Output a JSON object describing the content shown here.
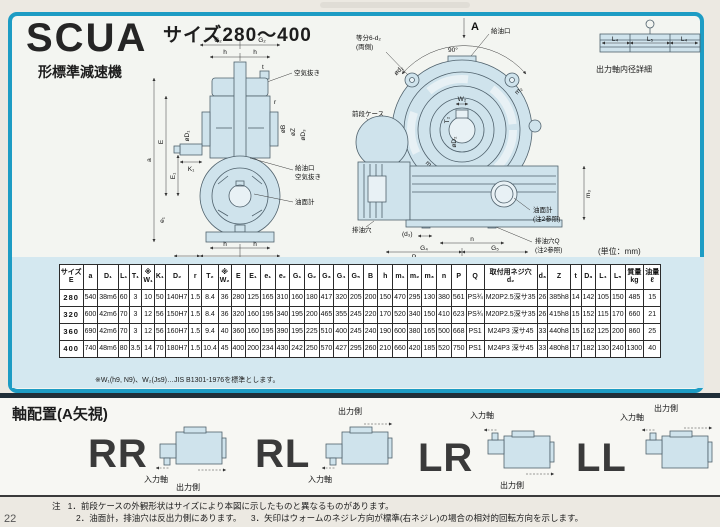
{
  "header": {
    "model": "SCUA",
    "subtitle": "形標準減速機",
    "size_range": "サイズ280～400"
  },
  "unit_note": "(単位：mm)",
  "drawings": {
    "side": {
      "G2": "G₂",
      "h": "h",
      "t": "t",
      "air_vent": "空気抜き",
      "a": "a",
      "E": "E",
      "E1": "E₁",
      "e1": "e₁",
      "dia_D1": "øD₁",
      "K1": "K₁",
      "r": "r",
      "dia_B": "øB",
      "dia_Z": "øZ",
      "dia_D3": "øD₃",
      "oil_port": "給油口",
      "air_vent2": "空気抜き",
      "oil_gauge": "油面計",
      "L1": "L₁",
      "G1": "G₁"
    },
    "front": {
      "A": "A",
      "deg": "90°",
      "bolt1": "等分6-d₂",
      "bolt2": "(両側)",
      "dia_d2": "ød₂",
      "oil_port": "給油口",
      "front_case": "前段ケース",
      "W2": "W₂",
      "T2": "T₂",
      "dia_D2": "øD₂",
      "m1": "m₁",
      "m2": "m₂",
      "m3": "m₃",
      "drain": "排油穴",
      "d3": "(d₃)",
      "n": "n",
      "G4": "G₄",
      "G5": "G₅",
      "P": "P",
      "gauge": "油面計",
      "ref": "(注2参照)",
      "drainQ": "排油穴Q"
    },
    "detail": {
      "L4": "L₄",
      "L5": "L₅",
      "caption": "出力軸内径詳細"
    }
  },
  "table": {
    "headers": [
      "サイズ\nE",
      "a",
      "D₁",
      "L₁",
      "T₁",
      "※\nW₁",
      "K₁",
      "D₂",
      "r",
      "T₂",
      "※\nW₂",
      "E",
      "E₁",
      "e₁",
      "e₂",
      "G₁",
      "G₂",
      "G₃",
      "G₄",
      "G₅",
      "B",
      "h",
      "m₁",
      "m₂",
      "m₃",
      "n",
      "P",
      "Q",
      "取付用ネジ穴\nd₂",
      "d₃",
      "Z",
      "t",
      "D₃",
      "L₄",
      "L₅",
      "質量\nkg",
      "油量\nℓ"
    ],
    "rows": [
      {
        "size": "280",
        "values": [
          "540",
          "38m6",
          "60",
          "3",
          "10",
          "50",
          "140H7",
          "1.5",
          "8.4",
          "36",
          "280",
          "125",
          "165",
          "310",
          "160",
          "180",
          "417",
          "320",
          "205",
          "200",
          "150",
          "470",
          "295",
          "130",
          "380",
          "561",
          "PS¾",
          "M20P2.5深サ35",
          "26",
          "385h8",
          "14",
          "142",
          "105",
          "150",
          "485",
          "15"
        ]
      },
      {
        "size": "320",
        "values": [
          "600",
          "42m6",
          "70",
          "3",
          "12",
          "56",
          "150H7",
          "1.5",
          "8.4",
          "36",
          "320",
          "160",
          "195",
          "340",
          "195",
          "200",
          "465",
          "355",
          "245",
          "220",
          "170",
          "520",
          "340",
          "150",
          "410",
          "623",
          "PS¾",
          "M20P2.5深サ35",
          "26",
          "415h8",
          "15",
          "152",
          "115",
          "170",
          "660",
          "21"
        ]
      },
      {
        "size": "360",
        "values": [
          "690",
          "42m6",
          "70",
          "3",
          "12",
          "56",
          "160H7",
          "1.5",
          "9.4",
          "40",
          "360",
          "160",
          "195",
          "390",
          "195",
          "225",
          "510",
          "400",
          "245",
          "240",
          "190",
          "600",
          "380",
          "165",
          "500",
          "668",
          "PS1",
          "M24P3 深サ45",
          "33",
          "440h8",
          "15",
          "162",
          "125",
          "200",
          "860",
          "25"
        ]
      },
      {
        "size": "400",
        "values": [
          "740",
          "48m6",
          "80",
          "3.5",
          "14",
          "70",
          "180H7",
          "1.5",
          "10.4",
          "45",
          "400",
          "200",
          "234",
          "430",
          "242",
          "250",
          "570",
          "427",
          "295",
          "260",
          "210",
          "660",
          "420",
          "185",
          "520",
          "750",
          "PS1",
          "M24P3 深サ45",
          "33",
          "480h8",
          "17",
          "182",
          "130",
          "240",
          "1300",
          "40"
        ]
      }
    ]
  },
  "table_note": "※W₁(h9, N9)、W₂(Js9)…JIS B1301-1976を標準とします。",
  "shaft_section": {
    "title": "軸配置(A矢視)",
    "input_label": "入力軸",
    "output_label": "出力側",
    "configs": [
      {
        "label": "RR"
      },
      {
        "label": "RL"
      },
      {
        "label": "LR"
      },
      {
        "label": "LL"
      }
    ]
  },
  "notes": {
    "prefix": "注",
    "n1": "1．前段ケースの外観形状はサイズにより本図に示したものと異なるものがあります。",
    "n2": "2．油面計，排油穴は反出力側にあります。",
    "n3": "3．矢印はウォームのネジレ方向が標準(右ネジレ)の場合の相対的回転方向を示します。"
  },
  "page_number": "22",
  "colors": {
    "frame": "#1d9cc4",
    "drawing_fill": "#cfe3ec",
    "table_band": "#d4e8f0",
    "divider": "#202e38"
  }
}
